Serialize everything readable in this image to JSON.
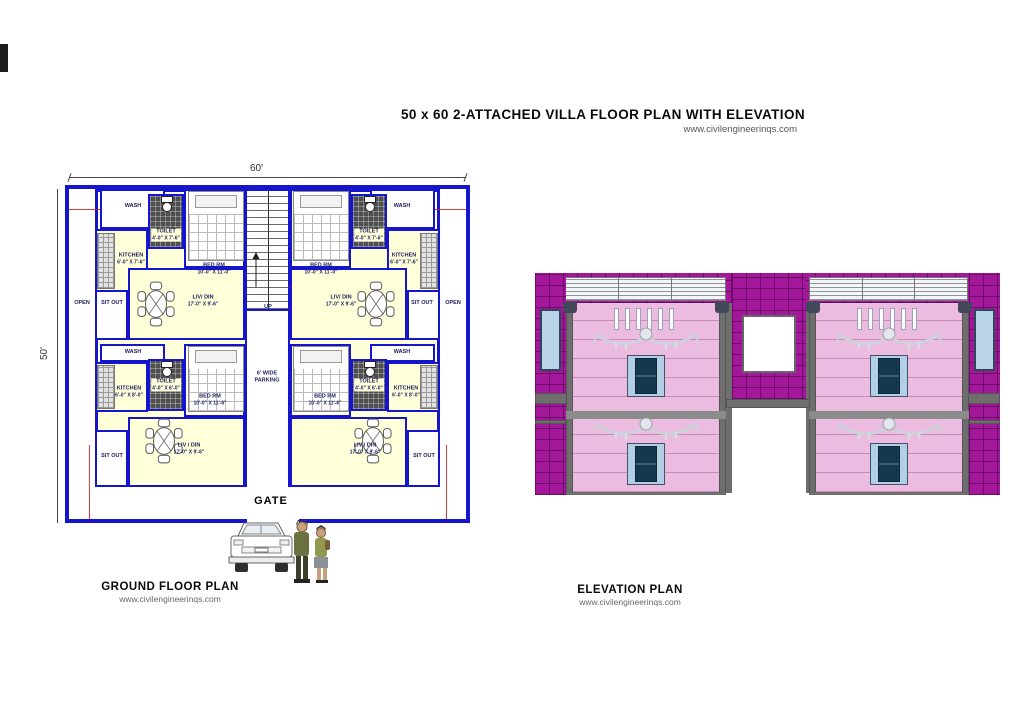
{
  "header": {
    "title": "50 x 60 2-ATTACHED VILLA FLOOR PLAN WITH ELEVATION",
    "website": "www.civilengineerinqs.com"
  },
  "plan": {
    "caption": "GROUND FLOOR PLAN",
    "website": "www.civilengineerinqs.com",
    "dims": {
      "width": "60'",
      "height": "50'"
    },
    "labels": {
      "gate": "GATE",
      "up": "UP",
      "parking": "6' WIDE PARKING",
      "open": "OPEN",
      "sit_out": "SIT OUT",
      "wash": "WASH"
    },
    "upper": {
      "toilet": "TOILET",
      "toilet_dim": "4'-0\" X 7'-6\"",
      "kitchen": "KITCHEN",
      "kitchen_dim": "6'-0\" X 7'-6\"",
      "bed": "BED RM",
      "bed_dim": "10'-0\" X 11'-0\"",
      "liv": "LIV/ DIN",
      "liv_dim": "17'-0\" X 9'-6\""
    },
    "lower": {
      "toilet": "TOILET",
      "toilet_dim": "4'-0\" X 6'-0\"",
      "kitchen": "KITCHEN",
      "kitchen_dim": "6'-0\" X 8'-0\"",
      "bed": "BED RM",
      "bed_dim": "10'-0\" X 11'-6\"",
      "liv": "LIV / DIN",
      "liv_dim": "17'-0\" X 9'-6\""
    }
  },
  "elevation": {
    "caption": "ELEVATION PLAN",
    "website": "www.civilengineerinqs.com"
  },
  "colors": {
    "wall_blue": "#1515CE",
    "room_yellow": "#FFFFD9",
    "brick_magenta": "#A3189B",
    "facade_pink": "#EBBCDF",
    "window_dark": "#15384E",
    "window_frame": "#B3CFE6",
    "band_gray": "#6E6E6E"
  }
}
